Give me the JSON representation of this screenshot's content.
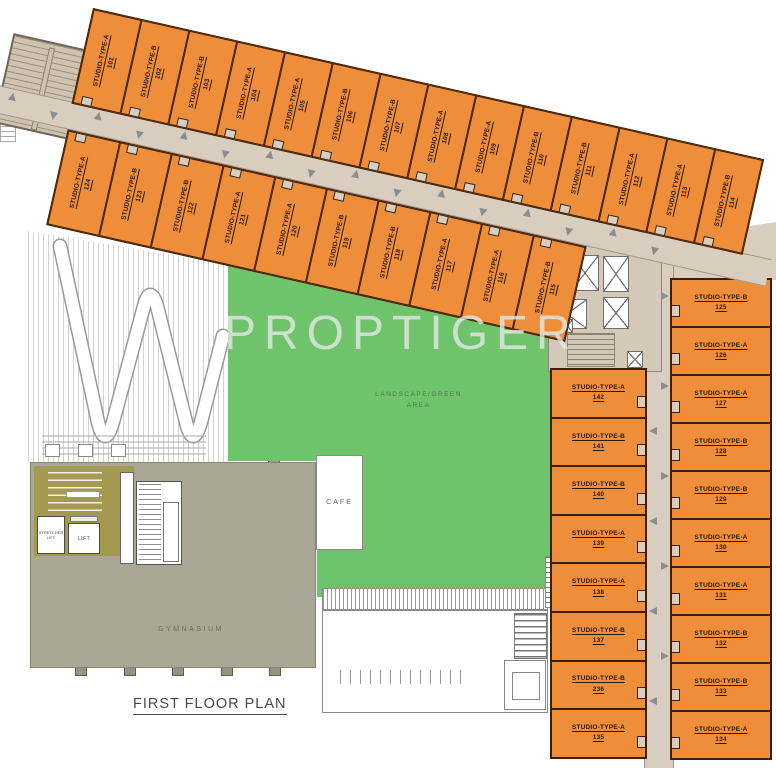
{
  "plan": {
    "title": "FIRST FLOOR PLAN",
    "watermark": "PROPTIGER",
    "labels": {
      "landscape_line1": "LANDSCAPE/GREEN",
      "landscape_line2": "AREA",
      "gymnasium": "GYMNASIUM",
      "cafe": "CAFE",
      "lift": "LIFT",
      "stretcher_lift": "STRETCHER LIFT"
    },
    "units": {
      "top_row": [
        {
          "type": "STUDIO-TYPE-A",
          "number": "101"
        },
        {
          "type": "STUDIO-TYPE-B",
          "number": "102"
        },
        {
          "type": "STUDIO-TYPE-B",
          "number": "103"
        },
        {
          "type": "STUDIO-TYPE-A",
          "number": "104"
        },
        {
          "type": "STUDIO-TYPE-A",
          "number": "105"
        },
        {
          "type": "STUDIO-TYPE-B",
          "number": "106"
        },
        {
          "type": "STUDIO-TYPE-B",
          "number": "107"
        },
        {
          "type": "STUDIO-TYPE-A",
          "number": "108"
        },
        {
          "type": "STUDIO-TYPE-A",
          "number": "109"
        },
        {
          "type": "STUDIO-TYPE-B",
          "number": "110"
        },
        {
          "type": "STUDIO-TYPE-B",
          "number": "111"
        },
        {
          "type": "STUDIO-TYPE-A",
          "number": "112"
        },
        {
          "type": "STUDIO-TYPE-A",
          "number": "113"
        },
        {
          "type": "STUDIO-TYPE-B",
          "number": "114"
        }
      ],
      "middle_row": [
        {
          "type": "STUDIO-TYPE-A",
          "number": "124"
        },
        {
          "type": "STUDIO-TYPE-B",
          "number": "123"
        },
        {
          "type": "STUDIO-TYPE-B",
          "number": "122"
        },
        {
          "type": "STUDIO-TYPE-A",
          "number": "121"
        },
        {
          "type": "STUDIO-TYPE-A",
          "number": "120"
        },
        {
          "type": "STUDIO-TYPE-B",
          "number": "119"
        },
        {
          "type": "STUDIO-TYPE-B",
          "number": "118"
        },
        {
          "type": "STUDIO-TYPE-A",
          "number": "117"
        },
        {
          "type": "STUDIO-TYPE-A",
          "number": "116"
        },
        {
          "type": "STUDIO-TYPE-B",
          "number": "115"
        }
      ],
      "right_inner_column": [
        {
          "type": "STUDIO-TYPE-A",
          "number": "142"
        },
        {
          "type": "STUDIO-TYPE-B",
          "number": "141"
        },
        {
          "type": "STUDIO-TYPE-B",
          "number": "140"
        },
        {
          "type": "STUDIO-TYPE-A",
          "number": "139"
        },
        {
          "type": "STUDIO-TYPE-A",
          "number": "138"
        },
        {
          "type": "STUDIO-TYPE-B",
          "number": "137"
        },
        {
          "type": "STUDIO-TYPE-B",
          "number": "236"
        },
        {
          "type": "STUDIO-TYPE-A",
          "number": "135"
        }
      ],
      "right_outer_column": [
        {
          "type": "STUDIO-TYPE-B",
          "number": "125"
        },
        {
          "type": "STUDIO-TYPE-A",
          "number": "126"
        },
        {
          "type": "STUDIO-TYPE-A",
          "number": "127"
        },
        {
          "type": "STUDIO-TYPE-B",
          "number": "128"
        },
        {
          "type": "STUDIO-TYPE-B",
          "number": "129"
        },
        {
          "type": "STUDIO-TYPE-A",
          "number": "130"
        },
        {
          "type": "STUDIO-TYPE-A",
          "number": "131"
        },
        {
          "type": "STUDIO-TYPE-B",
          "number": "132"
        },
        {
          "type": "STUDIO-TYPE-B",
          "number": "133"
        },
        {
          "type": "STUDIO-TYPE-A",
          "number": "134"
        }
      ]
    },
    "colors": {
      "unit_fill": "#ee8e3a",
      "unit_border": "#3c1f06",
      "corridor": "#d9cdbf",
      "green_area": "#6ec36b",
      "gym_fill": "#aaa796",
      "service_fill": "#a39950",
      "arrow": "#8d8d8d"
    }
  }
}
